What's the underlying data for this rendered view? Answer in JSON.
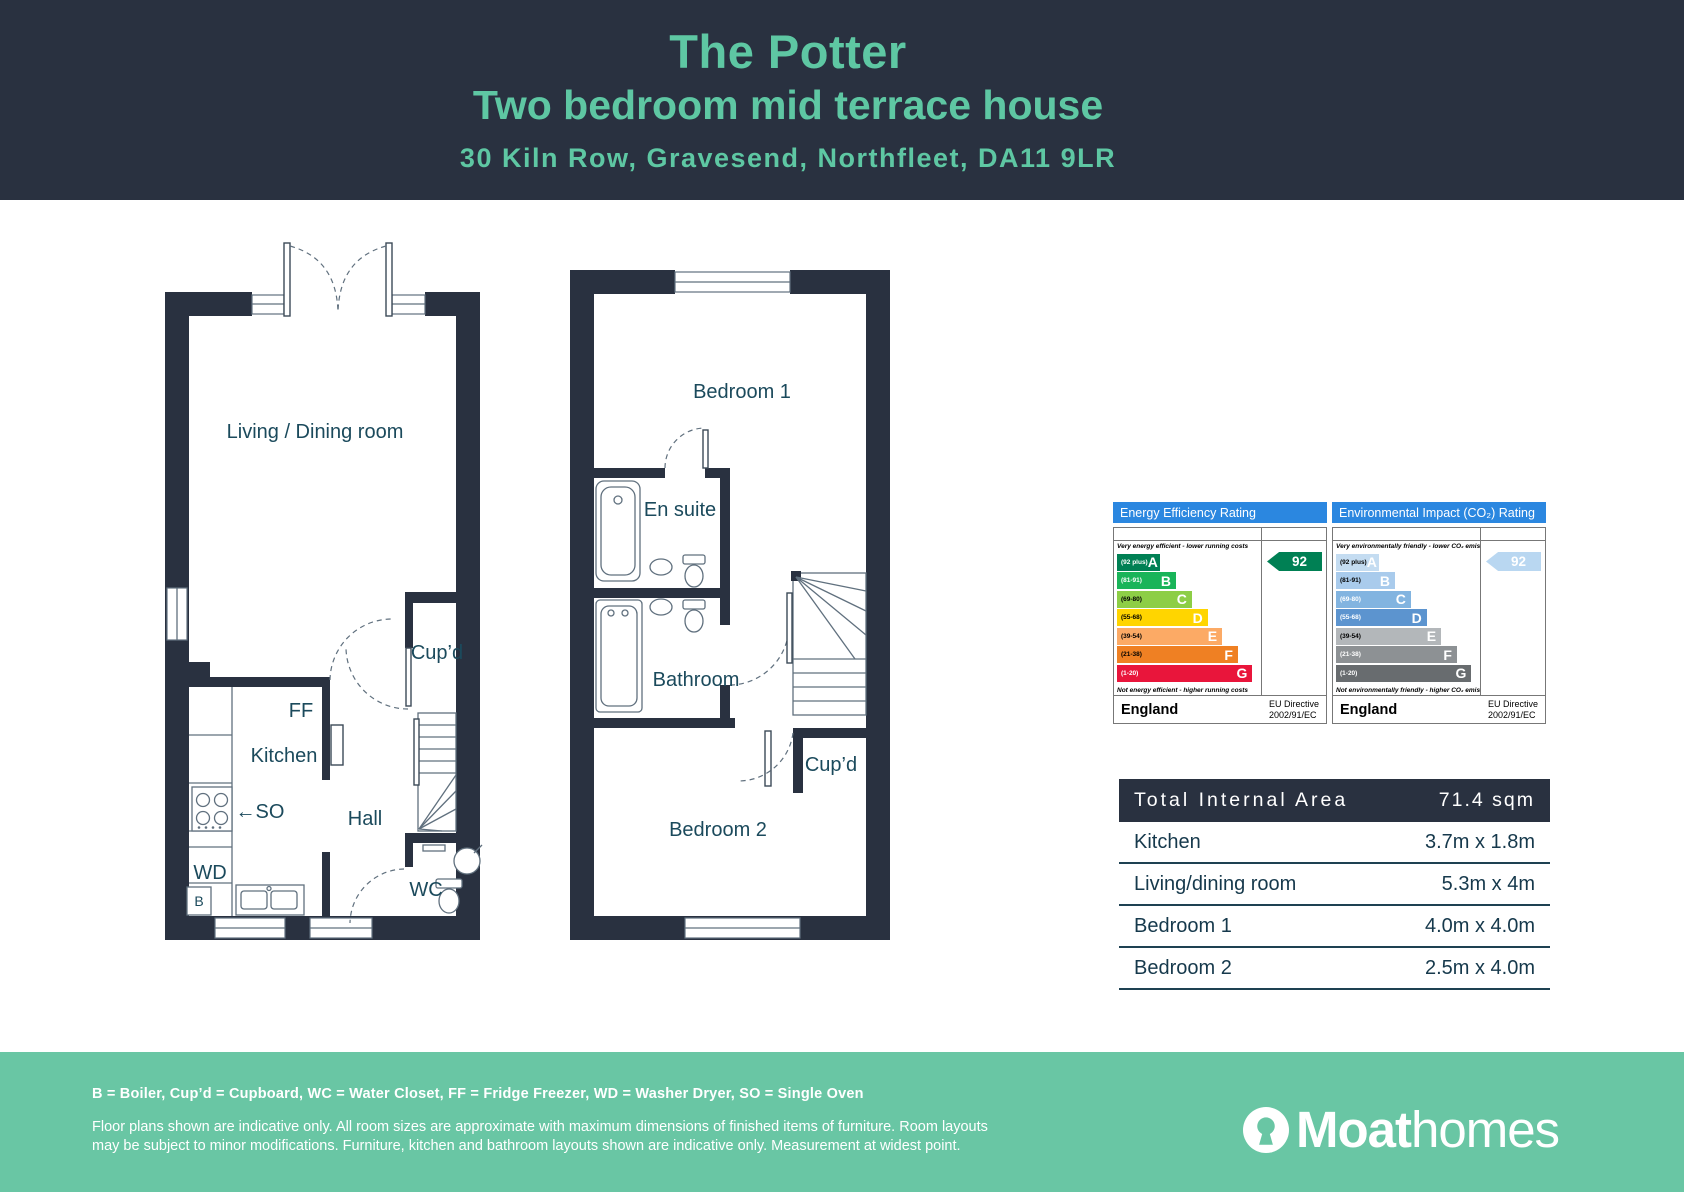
{
  "theme": {
    "dark": "#293140",
    "teal": "#5ec7a3",
    "footer_green": "#69c6a4",
    "epc_header_blue": "#2b87e0",
    "plan_label_color": "#1b4a5c"
  },
  "header": {
    "title": "The Potter",
    "subtitle": "Two bedroom mid terrace house",
    "address": "30 Kiln Row, Gravesend, Northfleet, DA11 9LR"
  },
  "floorplan_ground": {
    "labels": {
      "living_dining": "Living / Dining room",
      "cupboard": "Cup’d",
      "fridge_freezer": "FF",
      "kitchen": "Kitchen",
      "single_oven": "←SO",
      "hall": "Hall",
      "washer_dryer": "WD",
      "boiler": "B",
      "wc": "WC"
    }
  },
  "floorplan_first": {
    "labels": {
      "bedroom1": "Bedroom 1",
      "ensuite": "En suite",
      "bathroom": "Bathroom",
      "cupboard": "Cup’d",
      "bedroom2": "Bedroom 2"
    }
  },
  "epc": {
    "energy": {
      "title": "Energy Efficiency Rating",
      "top_note": "Very energy efficient - lower running costs",
      "bottom_note": "Not energy efficient - higher running costs",
      "current_rating": "92",
      "current_band": "A",
      "arrow_color": "#008054",
      "country": "England",
      "directive": "EU Directive\n2002/91/EC",
      "bands": [
        {
          "band": "A",
          "range": "(92 plus)",
          "color": "#008054",
          "range_color": "#ffffff",
          "width_pct": 30
        },
        {
          "band": "B",
          "range": "(81-91)",
          "color": "#19b459",
          "range_color": "#ffffff",
          "width_pct": 41
        },
        {
          "band": "C",
          "range": "(69-80)",
          "color": "#8dce46",
          "range_color": "#000000",
          "width_pct": 52
        },
        {
          "band": "D",
          "range": "(55-68)",
          "color": "#ffd500",
          "range_color": "#000000",
          "width_pct": 63
        },
        {
          "band": "E",
          "range": "(39-54)",
          "color": "#fcaa65",
          "range_color": "#000000",
          "width_pct": 73
        },
        {
          "band": "F",
          "range": "(21-38)",
          "color": "#ef8023",
          "range_color": "#000000",
          "width_pct": 84
        },
        {
          "band": "G",
          "range": "(1-20)",
          "color": "#e9153b",
          "range_color": "#ffffff",
          "width_pct": 94
        }
      ]
    },
    "environmental": {
      "title": "Environmental Impact (CO₂) Rating",
      "top_note": "Very environmentally friendly - lower CO₂ emissions",
      "bottom_note": "Not environmentally friendly - higher CO₂ emissions",
      "current_rating": "92",
      "current_band": "A",
      "arrow_color": "#b9d7f1",
      "country": "England",
      "directive": "EU Directive\n2002/91/EC",
      "bands": [
        {
          "band": "A",
          "range": "(92 plus)",
          "color": "#c4dcf1",
          "range_color": "#000000",
          "width_pct": 30
        },
        {
          "band": "B",
          "range": "(81-91)",
          "color": "#a9cbec",
          "range_color": "#000000",
          "width_pct": 41
        },
        {
          "band": "C",
          "range": "(69-80)",
          "color": "#82b4e0",
          "range_color": "#ffffff",
          "width_pct": 52
        },
        {
          "band": "D",
          "range": "(55-68)",
          "color": "#5c94cf",
          "range_color": "#ffffff",
          "width_pct": 63
        },
        {
          "band": "E",
          "range": "(39-54)",
          "color": "#b3b7ba",
          "range_color": "#000000",
          "width_pct": 73
        },
        {
          "band": "F",
          "range": "(21-38)",
          "color": "#8d9194",
          "range_color": "#ffffff",
          "width_pct": 84
        },
        {
          "band": "G",
          "range": "(1-20)",
          "color": "#686c6f",
          "range_color": "#ffffff",
          "width_pct": 94
        }
      ]
    }
  },
  "area_table": {
    "header": {
      "label": "Total Internal Area",
      "value": "71.4 sqm"
    },
    "rows": [
      {
        "label": "Kitchen",
        "value": "3.7m x 1.8m"
      },
      {
        "label": "Living/dining room",
        "value": "5.3m x 4m"
      },
      {
        "label": "Bedroom 1",
        "value": "4.0m x 4.0m"
      },
      {
        "label": "Bedroom 2",
        "value": "2.5m x 4.0m"
      }
    ]
  },
  "footer": {
    "legend": "B = Boiler, Cup’d = Cupboard, WC = Water Closet, FF = Fridge Freezer, WD = Washer Dryer, SO = Single Oven",
    "disclaimer": "Floor plans shown are indicative only. All room sizes are approximate with maximum dimensions of finished items of furniture. Room layouts may be subject to minor modifications. Furniture, kitchen and bathroom layouts shown are indicative only. Measurement at widest point.",
    "logo": {
      "brand_bold": "Moat",
      "brand_light": "homes"
    }
  }
}
